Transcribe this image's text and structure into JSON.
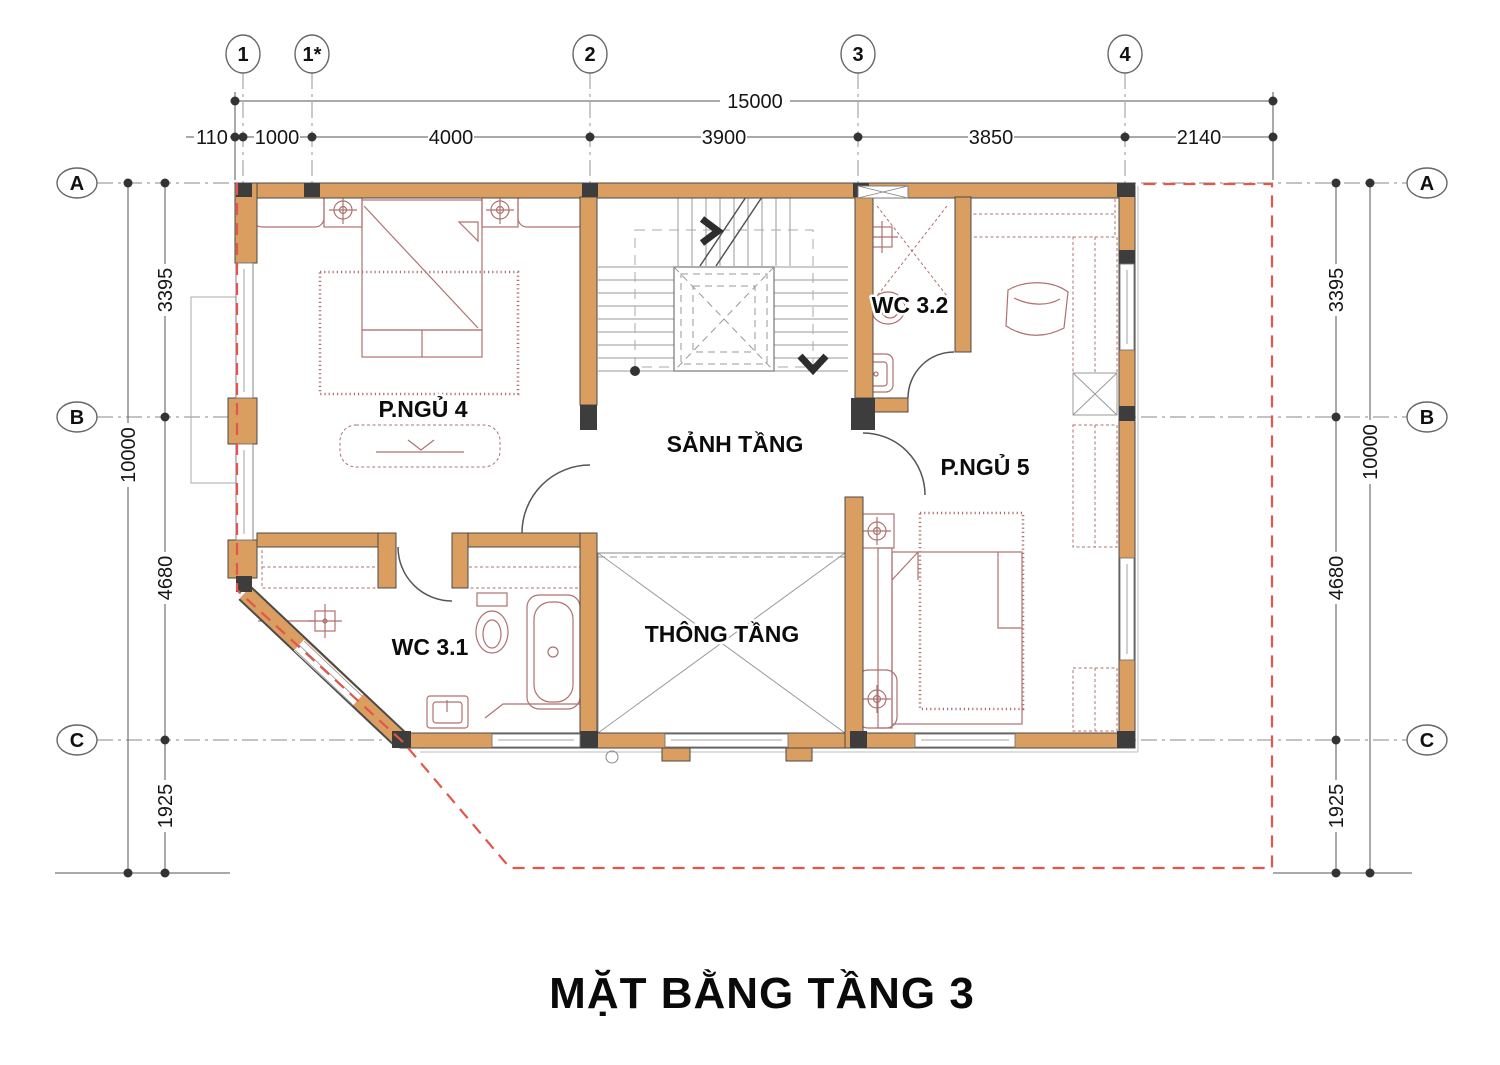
{
  "title": "MẶT BẰNG TẦNG 3",
  "colors": {
    "wall": "#d99e60",
    "column": "#3d3d3d",
    "furniture": "#b07070",
    "boundary": "#e2564b"
  },
  "grid": {
    "columns": [
      {
        "label": "1"
      },
      {
        "label": "1*"
      },
      {
        "label": "2"
      },
      {
        "label": "3"
      },
      {
        "label": "4"
      }
    ],
    "rows": [
      {
        "label": "A"
      },
      {
        "label": "B"
      },
      {
        "label": "C"
      }
    ]
  },
  "dimensions": {
    "total_width": "15000",
    "top_segments": [
      "110",
      "1000",
      "4000",
      "3900",
      "3850",
      "2140"
    ],
    "total_height": "10000",
    "side_segments": [
      "3395",
      "4680",
      "1925"
    ]
  },
  "rooms": {
    "bedroom4": "P.NGỦ 4",
    "hall": "SẢNH TẦNG",
    "wc32": "WC 3.2",
    "bedroom5": "P.NGỦ 5",
    "wc31": "WC 3.1",
    "void": "THÔNG TẦNG"
  }
}
